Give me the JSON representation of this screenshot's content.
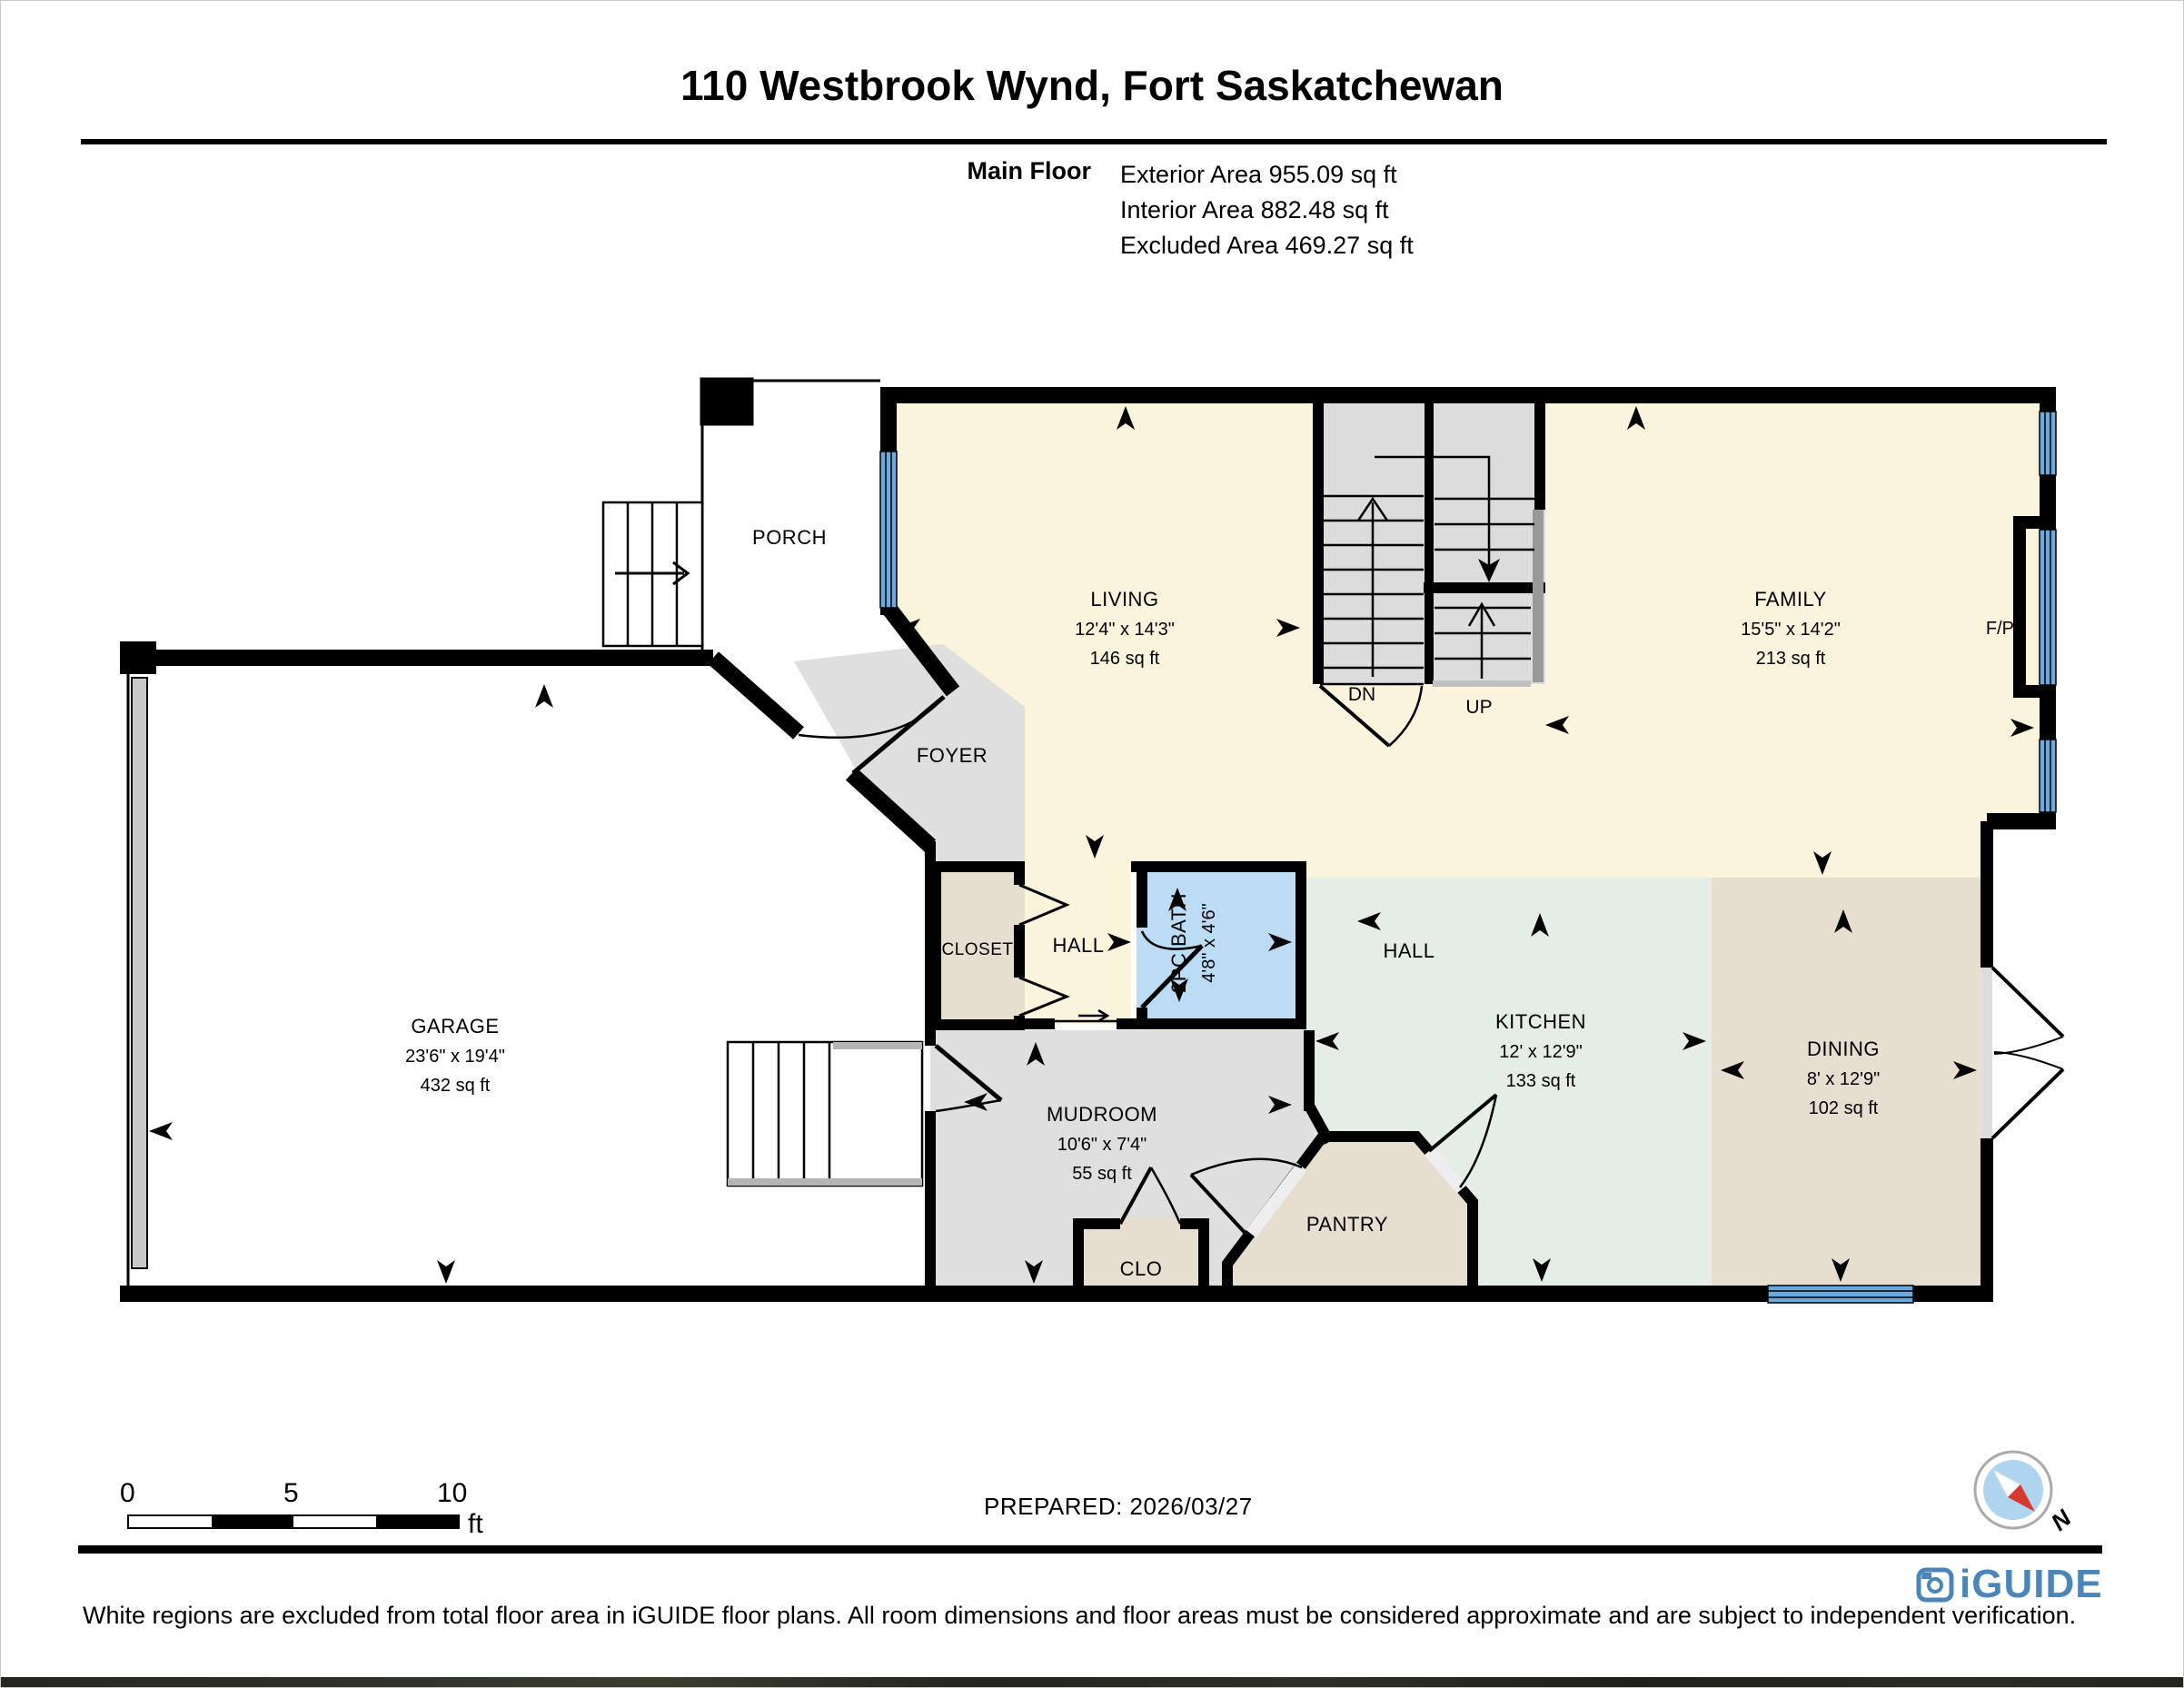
{
  "header": {
    "title": "110 Westbrook Wynd, Fort Saskatchewan",
    "floor_label": "Main Floor",
    "exterior_line": "Exterior Area 955.09 sq ft",
    "interior_line": "Interior Area 882.48 sq ft",
    "excluded_line": "Excluded Area 469.27 sq ft"
  },
  "rooms": {
    "living": {
      "name": "LIVING",
      "dims": "12'4\" x 14'3\"",
      "area": "146 sq ft"
    },
    "family": {
      "name": "FAMILY",
      "dims": "15'5\" x 14'2\"",
      "area": "213 sq ft"
    },
    "kitchen": {
      "name": "KITCHEN",
      "dims": "12' x 12'9\"",
      "area": "133 sq ft"
    },
    "dining": {
      "name": "DINING",
      "dims": "8' x 12'9\"",
      "area": "102 sq ft"
    },
    "garage": {
      "name": "GARAGE",
      "dims": "23'6\" x 19'4\"",
      "area": "432 sq ft"
    },
    "mudroom": {
      "name": "MUDROOM",
      "dims": "10'6\" x 7'4\"",
      "area": "55 sq ft"
    },
    "bath": {
      "name": "2PC BATH",
      "dims": "4'8\" x 4'6\""
    },
    "porch": {
      "name": "PORCH"
    },
    "foyer": {
      "name": "FOYER"
    },
    "hall_upper": {
      "name": "HALL"
    },
    "hall_lower": {
      "name": "HALL"
    },
    "closet": {
      "name": "CLOSET"
    },
    "clo": {
      "name": "CLO"
    },
    "pantry": {
      "name": "PANTRY"
    },
    "fireplace": {
      "name": "F/P"
    },
    "stairs": {
      "down": "DN",
      "up": "UP"
    }
  },
  "scale_bar": {
    "start": "0",
    "middle": "5",
    "end": "10",
    "unit": "ft"
  },
  "compass": {
    "north": "N"
  },
  "footer": {
    "prepared": "PREPARED: 2026/03/27",
    "disclaimer": "White regions are excluded from total floor area in iGUIDE floor plans. All room dimensions and floor areas must be considered approximate and are subject to independent verification.",
    "brand": "iGUIDE"
  },
  "colors": {
    "floor_cream": "#FAF4DC",
    "floor_gray": "#DFDFDF",
    "floor_tan": "#E6DECE",
    "floor_mint": "#E4EEE6",
    "floor_blue": "#BBDCF4",
    "window_blue": "#6FA8DC",
    "wall": "#000000",
    "brand_blue": "#4A86B8",
    "compass_red": "#D63B2F"
  }
}
